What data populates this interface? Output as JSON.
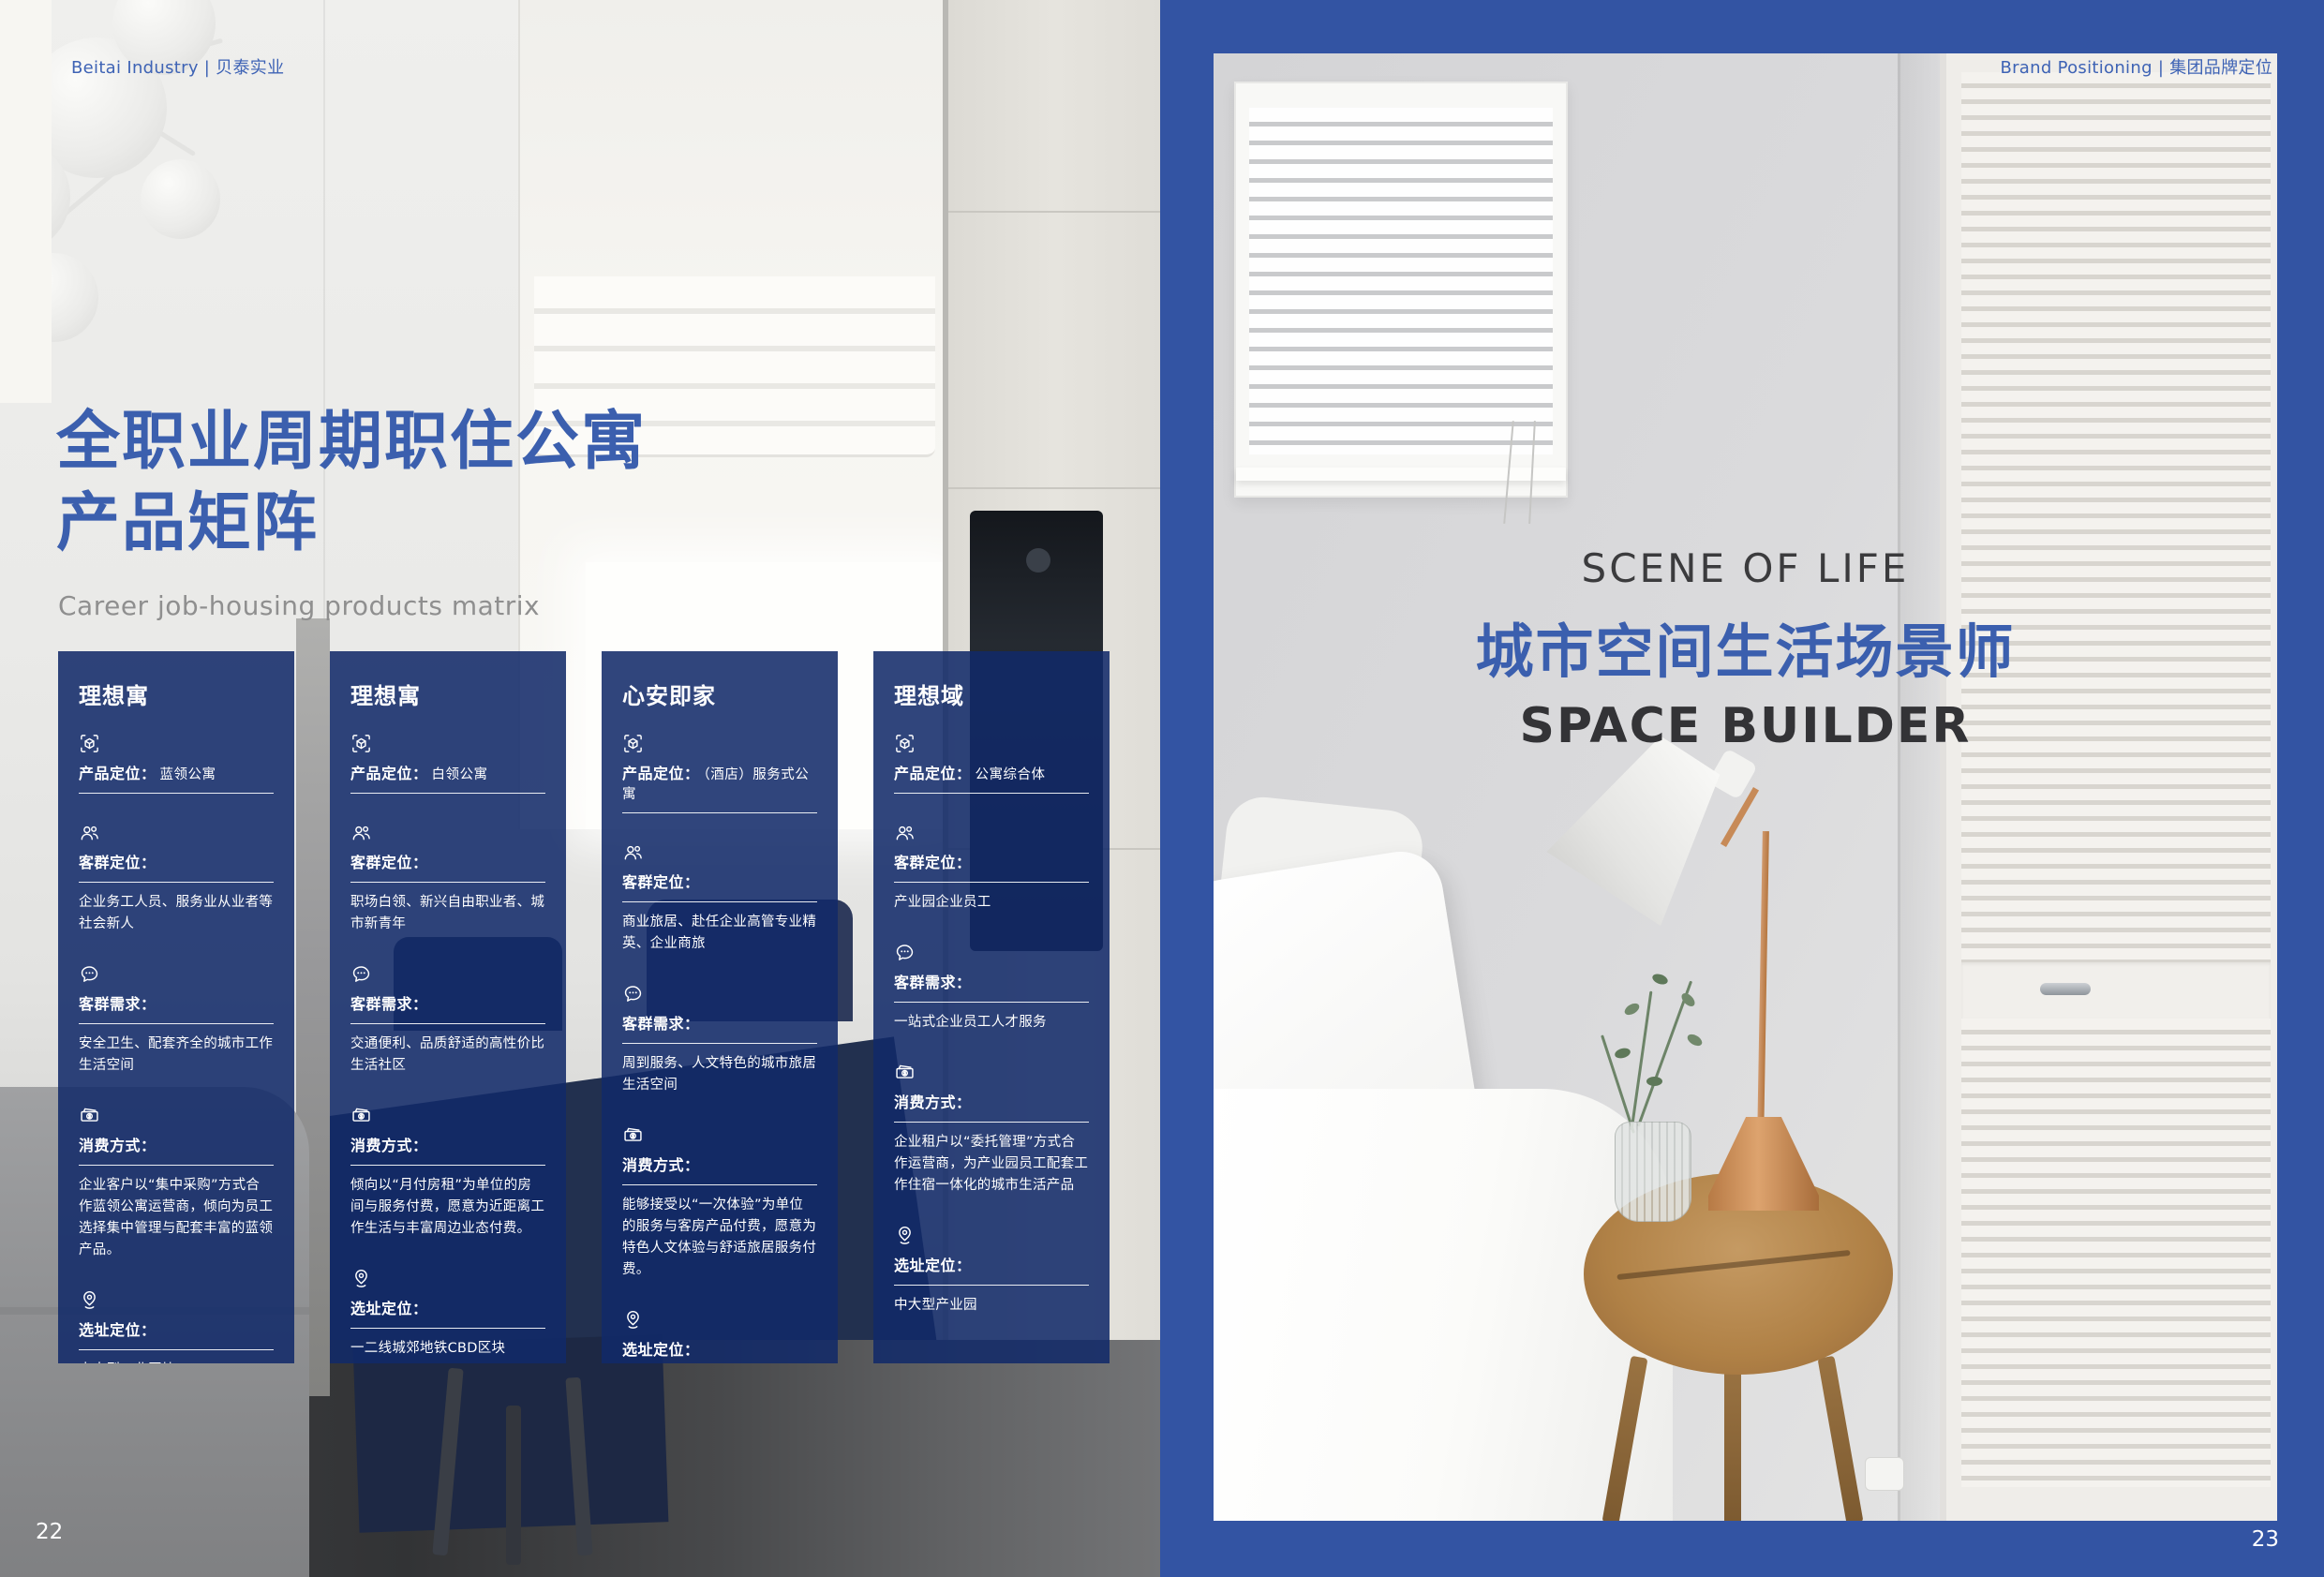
{
  "colors": {
    "accent_blue": "#3B5FAE",
    "frame_blue": "#3354A3",
    "card_overlay_blue": "#11296A",
    "heading_dark": "#333336",
    "subtitle_gray": "#8F8F8F",
    "white": "#FFFFFF"
  },
  "left": {
    "header": "Beitai Industry | 贝泰实业",
    "title_line1": "全职业周期职住公寓",
    "title_line2": "产品矩阵",
    "subtitle": "Career job-housing products matrix",
    "page_number": "22",
    "card_labels": {
      "product": "产品定位：",
      "audience": "客群定位：",
      "needs": "客群需求：",
      "spend": "消费方式：",
      "site": "选址定位："
    },
    "card_icons": {
      "product": "cube-icon",
      "audience": "users-icon",
      "needs": "chat-bubble-icon",
      "spend": "banknote-icon",
      "site": "location-pin-icon"
    },
    "cards": [
      {
        "title": "理想寓",
        "product_value": "蓝领公寓",
        "audience_value": "企业务工人员、服务业从业者等社会新人",
        "needs_value": "安全卫生、配套齐全的城市工作生活空间",
        "spend_value": "企业客户以“集中采购”方式合作蓝领公寓运营商，倾向为员工选择集中管理与配套丰富的蓝领产品。",
        "site_value": "中大型工业区块"
      },
      {
        "title": "理想寓",
        "product_value": "白领公寓",
        "audience_value": "职场白领、新兴自由职业者、城市新青年",
        "needs_value": "交通便利、品质舒适的高性价比生活社区",
        "spend_value": "倾向以“月付房租”为单位的房间与服务付费，愿意为近距离工作生活与丰富周边业态付费。",
        "site_value": "一二线城郊地铁CBD区块"
      },
      {
        "title": "心安即家",
        "product_value": "（酒店）服务式公寓",
        "audience_value": "商业旅居、赴任企业高管专业精英、企业商旅",
        "needs_value": "周到服务、人文特色的城市旅居生活空间",
        "spend_value": "能够接受以“一次体验”为单位的服务与客房产品付费，愿意为特色人文体验与舒适旅居服务付费。",
        "site_value": "一二线核心CBD区块"
      },
      {
        "title": "理想域",
        "product_value": "公寓综合体",
        "audience_value": "产业园企业员工",
        "needs_value": "一站式企业员工人才服务",
        "spend_value": "企业租户以“委托管理”方式合作运营商，为产业园员工配套工作住宿一体化的城市生活产品",
        "site_value": "中大型产业园"
      }
    ]
  },
  "right": {
    "header": "Brand Positioning | 集团品牌定位",
    "eyebrow": "SCENE OF LIFE",
    "title_cn": "城市空间生活场景师",
    "title_en": "SPACE BUILDER",
    "page_number": "23"
  }
}
